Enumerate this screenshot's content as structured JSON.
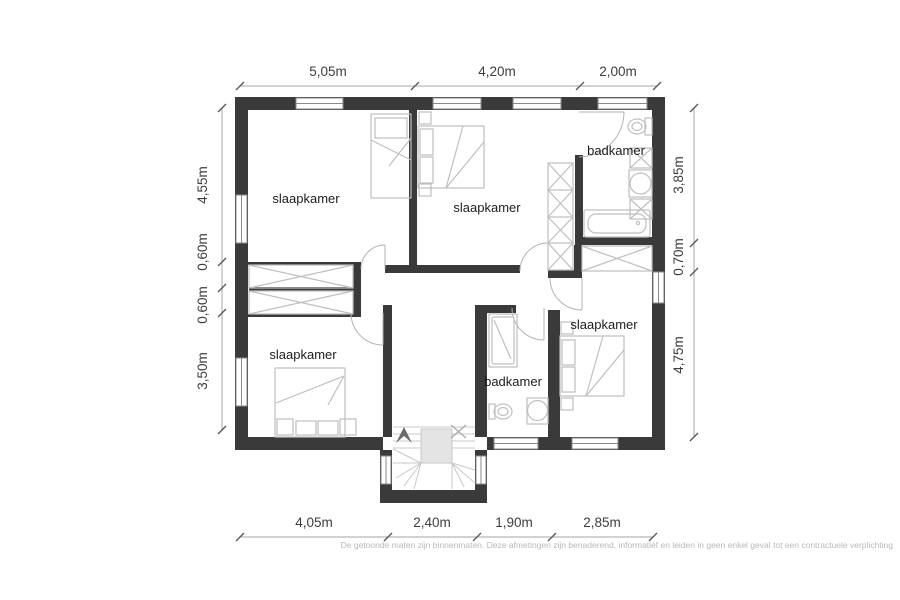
{
  "colors": {
    "wall": "#3a3a3a",
    "furniture": "#bfbfbf",
    "fixture": "#b3b3b3",
    "room_text": "#1d1d1d",
    "dim_text": "#3d3d3d",
    "dim_line": "#a6a6a6",
    "tick": "#555555",
    "disclaimer": "#b8b8b8",
    "stair_fill": "#e4e4e4",
    "stair_line": "#c9c9c9",
    "arrow": "#6b6b6b"
  },
  "rooms": {
    "bedroom_top_left": "slaapkamer",
    "bedroom_top_middle": "slaapkamer",
    "bathroom_top_right": "badkamer",
    "bedroom_bottom_left": "slaapkamer",
    "bathroom_bottom_middle": "badkamer",
    "bedroom_bottom_right": "slaapkamer"
  },
  "dimensions": {
    "top": [
      "5,05m",
      "4,20m",
      "2,00m"
    ],
    "left": [
      "4,55m",
      "0,60m",
      "0,60m",
      "3,50m"
    ],
    "right": [
      "3,85m",
      "0,70m",
      "4,75m"
    ],
    "bottom": [
      "4,05m",
      "2,40m",
      "1,90m",
      "2,85m"
    ]
  },
  "disclaimer": "De getoonde maten zijn binnenmaten. Deze afmetingen zijn benaderend, informatief en leiden in geen enkel geval tot een contractuele verplichting"
}
